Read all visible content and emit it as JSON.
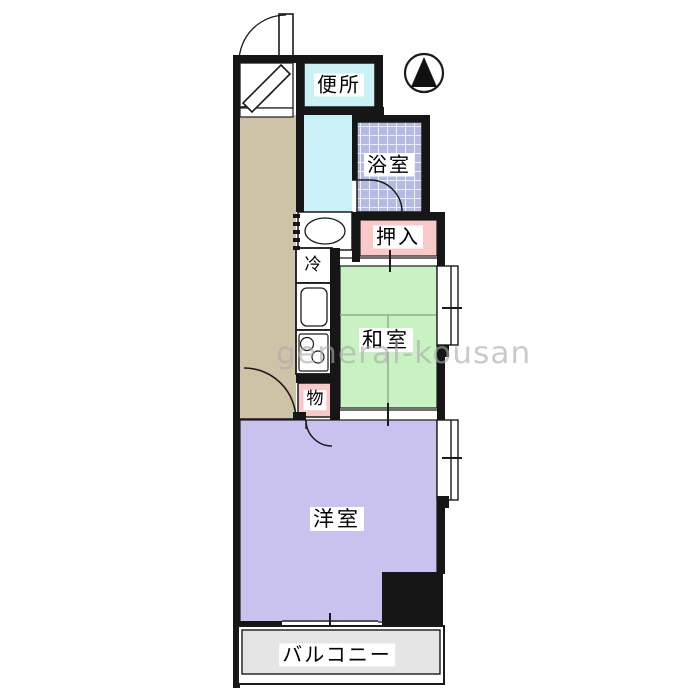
{
  "title": "floor-plan",
  "watermark": "general-kousan",
  "compass": {
    "icon": "north-arrow"
  },
  "rooms": {
    "toilet": {
      "label": "便所"
    },
    "bath": {
      "label": "浴室"
    },
    "closet": {
      "label": "押入"
    },
    "fridge": {
      "label": "冷"
    },
    "japanese_room": {
      "label": "和室"
    },
    "storage": {
      "label": "物"
    },
    "western_room": {
      "label": "洋室"
    },
    "balcony": {
      "label": "バルコニー"
    }
  },
  "colors": {
    "wall": "#161616",
    "hallway": "#cfc3a7",
    "water": "#c9f1f6",
    "tile": "#b5bae2",
    "tile_grid": "#ffffff",
    "pink": "#f9c9c9",
    "tatami": "#c9f2c3",
    "tatami_line": "#8fae8f",
    "purple": "#c9c2ee",
    "balcony_floor": "#e5e5e5",
    "outline": "#1a1a1a"
  }
}
